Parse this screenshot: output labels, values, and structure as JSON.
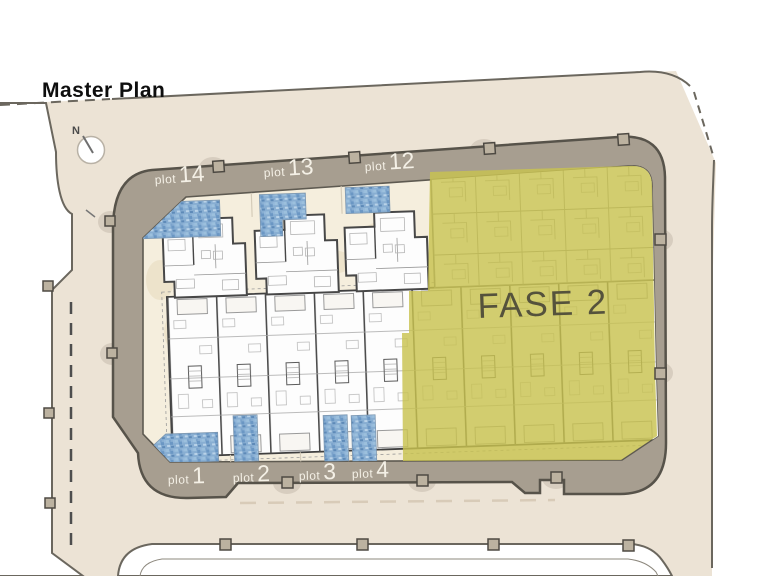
{
  "title": "Master Plan",
  "compass": {
    "label": "N"
  },
  "site": {
    "phase_label": "FASE 2",
    "plots_top": [
      {
        "prefix": "plot",
        "number": "14"
      },
      {
        "prefix": "plot",
        "number": "13"
      },
      {
        "prefix": "plot",
        "number": "12"
      }
    ],
    "plots_bottom": [
      {
        "prefix": "plot",
        "number": "1"
      },
      {
        "prefix": "plot",
        "number": "2"
      },
      {
        "prefix": "plot",
        "number": "3"
      },
      {
        "prefix": "plot",
        "number": "4"
      }
    ]
  },
  "colors": {
    "street_beige": "#ece3d5",
    "band_taupe": "#a79e90",
    "band_border": "#57534a",
    "plot_cream": "#f5eedd",
    "olive": "#c8c24f",
    "pool_blue": "#88aed2",
    "wall_gray": "#474747",
    "label_white": "#f4f0e6",
    "fase_text": "#55523c"
  }
}
